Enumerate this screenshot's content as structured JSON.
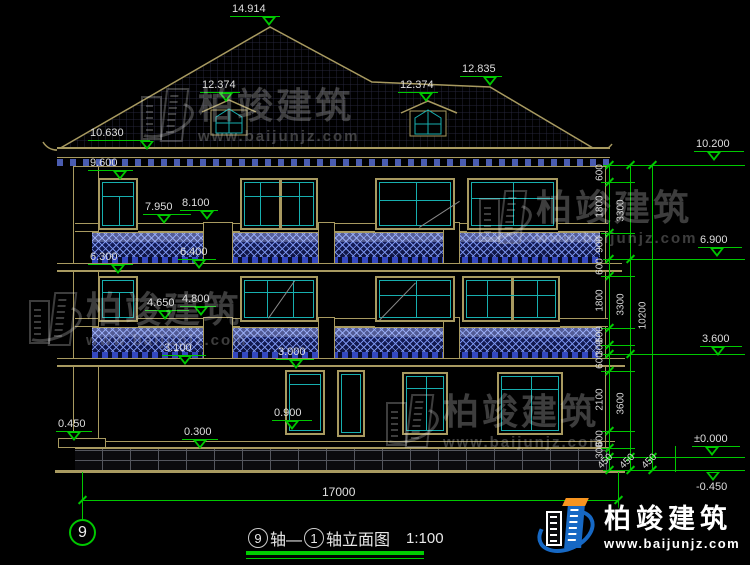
{
  "markers": [
    "14.914",
    "12.374",
    "12.374",
    "12.835",
    "10.630",
    "9.600",
    "7.950",
    "8.100",
    "6.300",
    "6.400",
    "4.650",
    "4.800",
    "3.100",
    "3.000",
    "0.900",
    "0.450",
    "0.300",
    "10.200",
    "6.900",
    "3.600",
    "±0.000",
    "-0.450"
  ],
  "right_dims": {
    "col_a": [
      "600",
      "1800",
      "900",
      "600",
      "1800",
      "600",
      "300",
      "600",
      "2100",
      "600",
      "300"
    ],
    "col_b": [
      "3300",
      "3300",
      "3600"
    ],
    "col_c": [
      "10200"
    ],
    "bottom": [
      "450",
      "450",
      "450"
    ]
  },
  "bottom_dim": {
    "total_width": "17000"
  },
  "axis": {
    "bubble": "9"
  },
  "title": {
    "axis_a": "9",
    "seg1": "轴—",
    "axis_b": "1",
    "seg2": "轴立面图",
    "scale": "1:100"
  },
  "watermark": {
    "name": "柏竣建筑",
    "url": "www.baijunjz.com"
  },
  "logo": {
    "name": "柏竣建筑",
    "url": "www.baijunjz.com"
  },
  "colors": {
    "linework": "#A89A60",
    "glass": "#17AFAF",
    "dimension": "#00C800",
    "lattice": "#3448C0",
    "logo_blue": "#1668C4",
    "logo_orange": "#F79420"
  }
}
